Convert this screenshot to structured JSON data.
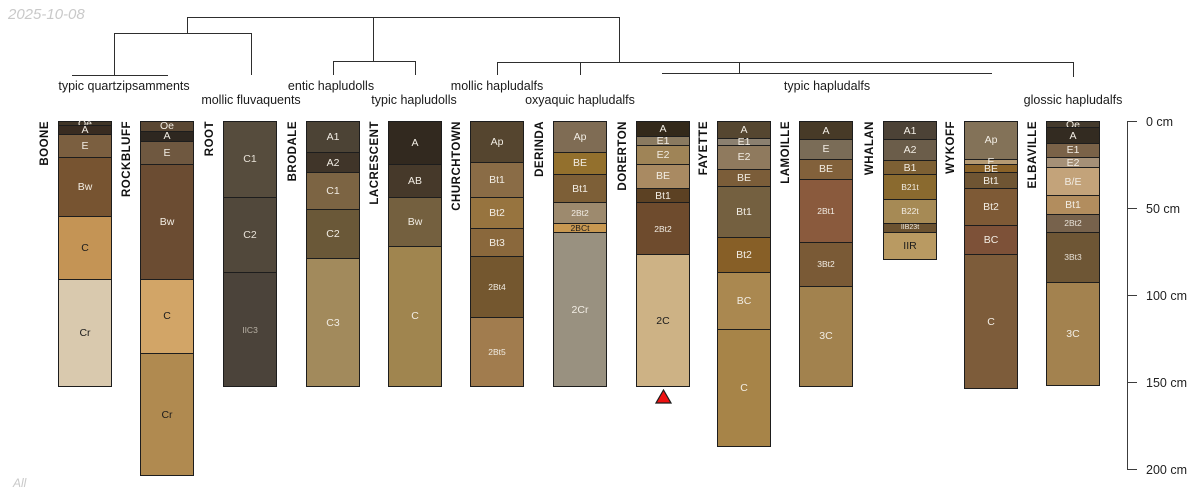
{
  "meta": {
    "watermark": "2025-10-08",
    "footer": "All"
  },
  "layout": {
    "col_width": 54,
    "y0": 121,
    "px_per_cm": 1.74,
    "line_color": "#2e2e2e"
  },
  "dendrogram": {
    "segments": [
      {
        "x1": 187,
        "y1": 17,
        "x2": 619,
        "y2": 17
      },
      {
        "x1": 114,
        "y1": 33,
        "x2": 251,
        "y2": 33
      },
      {
        "x1": 333,
        "y1": 61,
        "x2": 415,
        "y2": 61
      },
      {
        "x1": 497,
        "y1": 62,
        "x2": 1073,
        "y2": 62
      },
      {
        "x1": 72,
        "y1": 75,
        "x2": 168,
        "y2": 75
      },
      {
        "x1": 662,
        "y1": 73,
        "x2": 992,
        "y2": 73
      },
      {
        "x1": 187,
        "y1": 17,
        "x2": 187,
        "y2": 33
      },
      {
        "x1": 619,
        "y1": 17,
        "x2": 619,
        "y2": 62
      },
      {
        "x1": 373,
        "y1": 17,
        "x2": 373,
        "y2": 61
      },
      {
        "x1": 114,
        "y1": 33,
        "x2": 114,
        "y2": 75
      },
      {
        "x1": 251,
        "y1": 33,
        "x2": 251,
        "y2": 75
      },
      {
        "x1": 333,
        "y1": 61,
        "x2": 333,
        "y2": 75
      },
      {
        "x1": 415,
        "y1": 61,
        "x2": 415,
        "y2": 75
      },
      {
        "x1": 497,
        "y1": 62,
        "x2": 497,
        "y2": 75
      },
      {
        "x1": 580,
        "y1": 62,
        "x2": 580,
        "y2": 75
      },
      {
        "x1": 739,
        "y1": 62,
        "x2": 739,
        "y2": 73
      },
      {
        "x1": 1073,
        "y1": 62,
        "x2": 1073,
        "y2": 77
      }
    ],
    "labels": [
      {
        "text": "typic quartzipsamments",
        "x": 124,
        "y": 79
      },
      {
        "text": "mollic fluvaquents",
        "x": 251,
        "y": 93
      },
      {
        "text": "entic hapludolls",
        "x": 331,
        "y": 79
      },
      {
        "text": "typic hapludolls",
        "x": 414,
        "y": 93
      },
      {
        "text": "mollic hapludalfs",
        "x": 497,
        "y": 79
      },
      {
        "text": "oxyaquic hapludalfs",
        "x": 580,
        "y": 93
      },
      {
        "text": "typic hapludalfs",
        "x": 827,
        "y": 79
      },
      {
        "text": "glossic hapludalfs",
        "x": 1073,
        "y": 93
      }
    ]
  },
  "axis": {
    "x": 1127,
    "top_cm": 0,
    "bottom_cm": 200,
    "tick_len": 10,
    "ticks": [
      {
        "cm": 0,
        "label": "0 cm"
      },
      {
        "cm": 50,
        "label": "50 cm"
      },
      {
        "cm": 100,
        "label": "100 cm"
      },
      {
        "cm": 150,
        "label": "150 cm"
      },
      {
        "cm": 200,
        "label": "200 cm"
      }
    ]
  },
  "marker": {
    "name": "red-triangle-marker",
    "color": "#ee1111",
    "stroke": "#1c1c1c",
    "x": 663,
    "y": 389
  },
  "profiles": [
    {
      "name": "BOONE",
      "left": 58,
      "horizons": [
        {
          "name": "Oe",
          "top": 0,
          "bottom": 2,
          "color": "#403527",
          "text": "#f2ede4"
        },
        {
          "name": "A",
          "top": 2,
          "bottom": 7,
          "color": "#392c21",
          "text": "#f2ede4"
        },
        {
          "name": "E",
          "top": 7,
          "bottom": 20,
          "color": "#7b5f40",
          "text": "#f2ede4"
        },
        {
          "name": "Bw",
          "top": 20,
          "bottom": 54,
          "color": "#775431",
          "text": "#f2ede4"
        },
        {
          "name": "C",
          "top": 54,
          "bottom": 90,
          "color": "#c49455",
          "text": "#1c1c1c"
        },
        {
          "name": "Cr",
          "top": 90,
          "bottom": 152,
          "color": "#d9c9ae",
          "text": "#1c1c1c"
        }
      ]
    },
    {
      "name": "ROCKBLUFF",
      "left": 140,
      "horizons": [
        {
          "name": "Oe",
          "top": 0,
          "bottom": 5,
          "color": "#5a4733",
          "text": "#f2ede4"
        },
        {
          "name": "A",
          "top": 5,
          "bottom": 11,
          "color": "#2e2720",
          "text": "#f2ede4"
        },
        {
          "name": "E",
          "top": 11,
          "bottom": 24,
          "color": "#6f5840",
          "text": "#f2ede4"
        },
        {
          "name": "Bw",
          "top": 24,
          "bottom": 90,
          "color": "#6b4c32",
          "text": "#f2ede4"
        },
        {
          "name": "C",
          "top": 90,
          "bottom": 133,
          "color": "#d2a567",
          "text": "#1c1c1c"
        },
        {
          "name": "Cr",
          "top": 133,
          "bottom": 203,
          "color": "#b08a50",
          "text": "#1c1c1c"
        }
      ]
    },
    {
      "name": "ROOT",
      "left": 223,
      "horizons": [
        {
          "name": "C1",
          "top": 0,
          "bottom": 43,
          "color": "#564c3d",
          "text": "#e8e2d8"
        },
        {
          "name": "C2",
          "top": 43,
          "bottom": 86,
          "color": "#51483b",
          "text": "#e8e2d8"
        },
        {
          "name": "IIC3",
          "top": 86,
          "bottom": 152,
          "color": "#4b433a",
          "text": "#b9b2a6"
        }
      ]
    },
    {
      "name": "BRODALE",
      "left": 306,
      "horizons": [
        {
          "name": "A1",
          "top": 0,
          "bottom": 17,
          "color": "#4c4335",
          "text": "#f2ede4"
        },
        {
          "name": "A2",
          "top": 17,
          "bottom": 29,
          "color": "#403529",
          "text": "#f2ede4"
        },
        {
          "name": "C1",
          "top": 29,
          "bottom": 50,
          "color": "#7c6443",
          "text": "#f2ede4"
        },
        {
          "name": "C2",
          "top": 50,
          "bottom": 78,
          "color": "#6a5838",
          "text": "#f2ede4"
        },
        {
          "name": "C3",
          "top": 78,
          "bottom": 152,
          "color": "#a28a5c",
          "text": "#f2ede4"
        }
      ]
    },
    {
      "name": "LACRESCENT",
      "left": 388,
      "horizons": [
        {
          "name": "A",
          "top": 0,
          "bottom": 24,
          "color": "#32291f",
          "text": "#f2ede4"
        },
        {
          "name": "AB",
          "top": 24,
          "bottom": 43,
          "color": "#46392a",
          "text": "#f2ede4"
        },
        {
          "name": "Bw",
          "top": 43,
          "bottom": 71,
          "color": "#74603f",
          "text": "#f2ede4"
        },
        {
          "name": "C",
          "top": 71,
          "bottom": 152,
          "color": "#a0854f",
          "text": "#f2ede4"
        }
      ]
    },
    {
      "name": "CHURCHTOWN",
      "left": 470,
      "horizons": [
        {
          "name": "Ap",
          "top": 0,
          "bottom": 23,
          "color": "#55452f",
          "text": "#f2ede4"
        },
        {
          "name": "Bt1",
          "top": 23,
          "bottom": 43,
          "color": "#8a6c46",
          "text": "#f2ede4"
        },
        {
          "name": "Bt2",
          "top": 43,
          "bottom": 61,
          "color": "#97743f",
          "text": "#f2ede4"
        },
        {
          "name": "Bt3",
          "top": 61,
          "bottom": 77,
          "color": "#8a683c",
          "text": "#f2ede4"
        },
        {
          "name": "2Bt4",
          "top": 77,
          "bottom": 112,
          "color": "#74572f",
          "text": "#f2ede4"
        },
        {
          "name": "2Bt5",
          "top": 112,
          "bottom": 152,
          "color": "#a17c4e",
          "text": "#f2ede4"
        }
      ]
    },
    {
      "name": "DERINDA",
      "left": 553,
      "horizons": [
        {
          "name": "Ap",
          "top": 0,
          "bottom": 17,
          "color": "#7f6c54",
          "text": "#f2ede4"
        },
        {
          "name": "BE",
          "top": 17,
          "bottom": 30,
          "color": "#93702d",
          "text": "#f2ede4"
        },
        {
          "name": "Bt1",
          "top": 30,
          "bottom": 46,
          "color": "#7d5f37",
          "text": "#f2ede4"
        },
        {
          "name": "2Bt2",
          "top": 46,
          "bottom": 58,
          "color": "#9d8a6e",
          "text": "#f2ede4"
        },
        {
          "name": "2BCt",
          "top": 58,
          "bottom": 63,
          "color": "#c89851",
          "text": "#1c1c1c"
        },
        {
          "name": "2Cr",
          "top": 63,
          "bottom": 152,
          "color": "#999180",
          "text": "#f2ede4"
        }
      ]
    },
    {
      "name": "DORERTON",
      "left": 636,
      "horizons": [
        {
          "name": "A",
          "top": 0,
          "bottom": 8,
          "color": "#33291a",
          "text": "#f2ede4"
        },
        {
          "name": "E1",
          "top": 8,
          "bottom": 13,
          "color": "#8a7a60",
          "text": "#f2ede4"
        },
        {
          "name": "E2",
          "top": 13,
          "bottom": 24,
          "color": "#9f8457",
          "text": "#f2ede4"
        },
        {
          "name": "BE",
          "top": 24,
          "bottom": 38,
          "color": "#a98a62",
          "text": "#f2ede4"
        },
        {
          "name": "Bt1",
          "top": 38,
          "bottom": 46,
          "color": "#5c4123",
          "text": "#f2ede4"
        },
        {
          "name": "2Bt2",
          "top": 46,
          "bottom": 76,
          "color": "#6e4b2d",
          "text": "#f2ede4"
        },
        {
          "name": "2C",
          "top": 76,
          "bottom": 152,
          "color": "#cdb285",
          "text": "#1c1c1c"
        }
      ]
    },
    {
      "name": "FAYETTE",
      "left": 717,
      "horizons": [
        {
          "name": "A",
          "top": 0,
          "bottom": 9,
          "color": "#554630",
          "text": "#f2ede4"
        },
        {
          "name": "E1",
          "top": 9,
          "bottom": 13,
          "color": "#8b8070",
          "text": "#f2ede4"
        },
        {
          "name": "E2",
          "top": 13,
          "bottom": 27,
          "color": "#8f7a5e",
          "text": "#f2ede4"
        },
        {
          "name": "BE",
          "top": 27,
          "bottom": 37,
          "color": "#7b5d39",
          "text": "#f2ede4"
        },
        {
          "name": "Bt1",
          "top": 37,
          "bottom": 66,
          "color": "#746040",
          "text": "#f2ede4"
        },
        {
          "name": "Bt2",
          "top": 66,
          "bottom": 86,
          "color": "#875f27",
          "text": "#f2ede4"
        },
        {
          "name": "BC",
          "top": 86,
          "bottom": 119,
          "color": "#aa8850",
          "text": "#f2ede4"
        },
        {
          "name": "C",
          "top": 119,
          "bottom": 186,
          "color": "#a78448",
          "text": "#f2ede4"
        }
      ]
    },
    {
      "name": "LAMOILLE",
      "left": 799,
      "horizons": [
        {
          "name": "A",
          "top": 0,
          "bottom": 10,
          "color": "#473a27",
          "text": "#f2ede4"
        },
        {
          "name": "E",
          "top": 10,
          "bottom": 21,
          "color": "#7a6c57",
          "text": "#f2ede4"
        },
        {
          "name": "BE",
          "top": 21,
          "bottom": 33,
          "color": "#82613b",
          "text": "#f2ede4"
        },
        {
          "name": "2Bt1",
          "top": 33,
          "bottom": 69,
          "color": "#8a5a3d",
          "text": "#f2ede4"
        },
        {
          "name": "3Bt2",
          "top": 69,
          "bottom": 94,
          "color": "#7a5a36",
          "text": "#f2ede4"
        },
        {
          "name": "3C",
          "top": 94,
          "bottom": 152,
          "color": "#a2824e",
          "text": "#f2ede4"
        }
      ]
    },
    {
      "name": "WHALAN",
      "left": 883,
      "horizons": [
        {
          "name": "A1",
          "top": 0,
          "bottom": 10,
          "color": "#4c4236",
          "text": "#f2ede4"
        },
        {
          "name": "A2",
          "top": 10,
          "bottom": 22,
          "color": "#6b5d4a",
          "text": "#f2ede4"
        },
        {
          "name": "B1",
          "top": 22,
          "bottom": 30,
          "color": "#7d6034",
          "text": "#f2ede4"
        },
        {
          "name": "B21t",
          "top": 30,
          "bottom": 44,
          "color": "#8a6a2f",
          "text": "#f2ede4"
        },
        {
          "name": "B22t",
          "top": 44,
          "bottom": 58,
          "color": "#a68a55",
          "text": "#f2ede4"
        },
        {
          "name": "IIB23t",
          "top": 58,
          "bottom": 63,
          "color": "#6b5230",
          "text": "#f2ede4"
        },
        {
          "name": "IIR",
          "top": 63,
          "bottom": 79,
          "color": "#b99a62",
          "text": "#1c1c1c"
        }
      ]
    },
    {
      "name": "WYKOFF",
      "left": 964,
      "horizons": [
        {
          "name": "Ap",
          "top": 0,
          "bottom": 21,
          "color": "#837258",
          "text": "#f2ede4"
        },
        {
          "name": "E",
          "top": 21,
          "bottom": 24,
          "color": "#b59a72",
          "text": "#f2ede4"
        },
        {
          "name": "BE",
          "top": 24,
          "bottom": 29,
          "color": "#8a6228",
          "text": "#f2ede4"
        },
        {
          "name": "Bt1",
          "top": 29,
          "bottom": 38,
          "color": "#6f5533",
          "text": "#f2ede4"
        },
        {
          "name": "Bt2",
          "top": 38,
          "bottom": 59,
          "color": "#7e5a36",
          "text": "#f2ede4"
        },
        {
          "name": "BC",
          "top": 59,
          "bottom": 76,
          "color": "#7d5138",
          "text": "#f2ede4"
        },
        {
          "name": "C",
          "top": 76,
          "bottom": 153,
          "color": "#7d5c3a",
          "text": "#f2ede4"
        }
      ]
    },
    {
      "name": "ELBAVILLE",
      "left": 1046,
      "horizons": [
        {
          "name": "Oe",
          "top": 0,
          "bottom": 3,
          "color": "#443a2c",
          "text": "#f2ede4"
        },
        {
          "name": "A",
          "top": 3,
          "bottom": 12,
          "color": "#332b21",
          "text": "#f2ede4"
        },
        {
          "name": "E1",
          "top": 12,
          "bottom": 20,
          "color": "#7a6248",
          "text": "#f2ede4"
        },
        {
          "name": "E2",
          "top": 20,
          "bottom": 26,
          "color": "#a59077",
          "text": "#f2ede4"
        },
        {
          "name": "B/E",
          "top": 26,
          "bottom": 42,
          "color": "#c3a37a",
          "text": "#f2ede4"
        },
        {
          "name": "Bt1",
          "top": 42,
          "bottom": 53,
          "color": "#b28d5e",
          "text": "#f2ede4"
        },
        {
          "name": "2Bt2",
          "top": 53,
          "bottom": 63,
          "color": "#77624c",
          "text": "#e8e2d8"
        },
        {
          "name": "3Bt3",
          "top": 63,
          "bottom": 92,
          "color": "#6e5635",
          "text": "#e8e2d8"
        },
        {
          "name": "3C",
          "top": 92,
          "bottom": 151,
          "color": "#a3824f",
          "text": "#f2ede4"
        }
      ]
    }
  ]
}
